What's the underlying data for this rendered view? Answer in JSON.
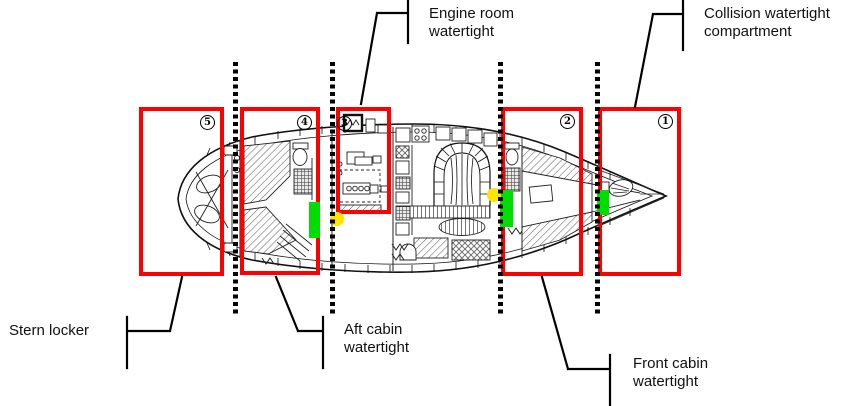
{
  "diagram": {
    "description": "Yacht deck plan showing watertight compartments",
    "compartments": [
      {
        "number": "1",
        "name": "Collision watertight compartment"
      },
      {
        "number": "2",
        "name": "Front cabin watertight"
      },
      {
        "number": "3",
        "name": "Engine room watertight"
      },
      {
        "number": "4",
        "name": "Aft cabin watertight"
      },
      {
        "number": "5",
        "name": "Stern locker"
      }
    ],
    "labels": {
      "engine_room": "Engine room\nwatertight",
      "collision": "Collision watertight\ncompartment",
      "stern_locker": "Stern locker",
      "aft_cabin": "Aft cabin\nwatertight",
      "front_cabin": "Front cabin\nwatertight"
    },
    "colors": {
      "compartment_outline": "#ff0000",
      "watertight_door_marker": "#00dd00",
      "position_marker": "#ffe400",
      "bulkhead_line": "#000000"
    }
  }
}
